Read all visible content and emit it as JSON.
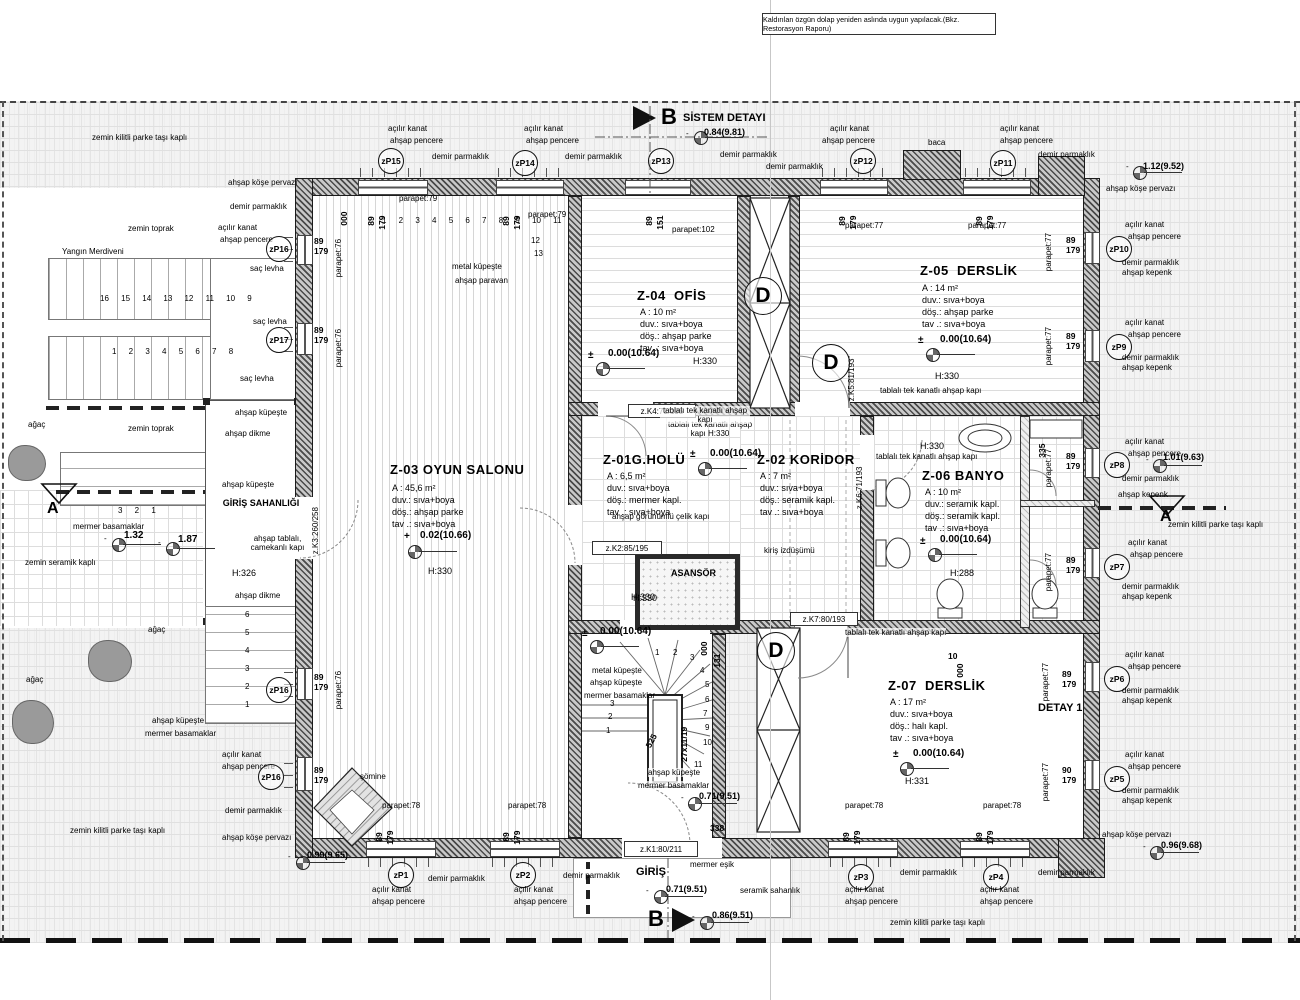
{
  "note": "Kaldırılan özgün dolap yeniden aslında uygun yapılacak.(Bkz. Restorasyon Raporu)",
  "markers": {
    "b": "B",
    "a": "A",
    "sistem_detayi": "SİSTEM DETAYI",
    "detay1": "DETAY 1"
  },
  "terms": {
    "acilir_kanat": "açılır kanat",
    "ahsap_pencere": "ahşap pencere",
    "demir_parmaklik": "demir parmaklık",
    "ahsap_kepenk": "ahşap kepenk",
    "ahsap_kose_pervazi": "ahşap köşe pervazı",
    "zemin_kilitli": "zemin kilitli parke taşı kaplı",
    "zemin_toprak": "zemin toprak",
    "zemin_seramik": "zemin seramik kaplı",
    "sac_levha": "saç levha",
    "agac": "ağaç",
    "ahsap_kupeste": "ahşap küpeşte",
    "ahsap_dikme": "ahşap dikme",
    "mermer_basamaklar": "mermer basamaklar",
    "metal_kupeste": "metal küpeşte",
    "ahsap_paravan": "ahşap paravan",
    "tablali_kapi": "tablalı tek kanatlı ahşap kapı",
    "celik_kapi": "ahşap görünümlü çelik kapı",
    "camekanli_kapi": "ahşap tablalı, camekanlı kapı",
    "somine": "şömine",
    "baca": "baca",
    "yangin_merdiveni": "Yangın Merdiveni",
    "kiris_izdusumu": "kiriş izdüşümü",
    "mermer_esik": "mermer eşik",
    "seramik_sahanlik": "seramik sahanlık",
    "giris": "GİRİŞ",
    "giris_sahanligi": "GİRİŞ SAHANLIĞI",
    "asansor": "ASANSÖR"
  },
  "rooms": {
    "z03": {
      "id": "Z-03",
      "name": "OYUN SALONU",
      "area": "A   : 45,6  m²",
      "duv": "duv.: sıva+boya",
      "dos": "döş.: ahşap parke",
      "tav": "tav .: sıva+boya",
      "sign": "+",
      "level": "0.02(10.66)",
      "height": "H:330"
    },
    "z04": {
      "id": "Z-04",
      "name": "OFİS",
      "area": "A   : 10  m²",
      "duv": "duv.: sıva+boya",
      "dos": "döş.: ahşap parke",
      "tav": "tav .: sıva+boya",
      "sign": "±",
      "level": "0.00(10.64)",
      "height": "H:330"
    },
    "z05": {
      "id": "Z-05",
      "name": "DERSLİK",
      "area": "A   : 14  m²",
      "duv": "duv.: sıva+boya",
      "dos": "döş.: ahşap parke",
      "tav": "tav .: sıva+boya",
      "sign": "±",
      "level": "0.00(10.64)",
      "height": "H:330"
    },
    "z01": {
      "id": "Z-01",
      "name": "G.HOLÜ",
      "area": "A   : 6,5  m²",
      "duv": "duv.: sıva+boya",
      "dos": "döş.: mermer kapl.",
      "tav": "tav .: sıva+boya",
      "sign": "±",
      "level": "0.00(10.64)",
      "height": "H:330"
    },
    "z02": {
      "id": "Z-02",
      "name": "KORİDOR",
      "area": "A   : 7  m²",
      "duv": "duv.: sıva+boya",
      "dos": "döş.: seramik kapl.",
      "tav": "tav .: sıva+boya"
    },
    "z06": {
      "id": "Z-06",
      "name": "BANYO",
      "area": "A   : 10  m²",
      "duv": "duv.: seramik kapl.",
      "dos": "döş.: seramik kapl.",
      "tav": "tav .: sıva+boya",
      "sign": "±",
      "level": "0.00(10.64)",
      "height": "H:288"
    },
    "z07": {
      "id": "Z-07",
      "name": "DERSLİK",
      "area": "A   : 17  m²",
      "duv": "duv.: sıva+boya",
      "dos": "döş.: halı kapl.",
      "tav": "tav .: sıva+boya",
      "sign": "±",
      "level": "0.00(10.64)",
      "height": "H:331"
    }
  },
  "doors": {
    "k1": "z.K1:80/211",
    "k2": "z.K2:85/195",
    "k3": "z.K3:260/258",
    "k4": "z.K4:71/195",
    "k5": "z.K5:81/193",
    "k6": "z.K6:71/193",
    "k7": "z.K7:80/193"
  },
  "window_tags": {
    "p1": "zP1",
    "p2": "zP2",
    "p3": "zP3",
    "p4": "zP4",
    "p5": "zP5",
    "p6": "zP6",
    "p7": "zP7",
    "p8": "zP8",
    "p9": "zP9",
    "p10": "zP10",
    "p11": "zP11",
    "p12": "zP12",
    "p13": "zP13",
    "p14": "zP14",
    "p15": "zP15",
    "p16": "zP16",
    "p17": "zP17"
  },
  "levels": {
    "l084": "0.84(9.81)",
    "l112": "1.12(9.52)",
    "l101": "1.01(9.63)",
    "l071": "0.71(9.51)",
    "l086": "0.86(9.51)",
    "l099": "0.99(9.65)",
    "l096": "0.96(9.68)",
    "l132": "1.32",
    "l187": "1.87",
    "minus": "-"
  },
  "dims": {
    "d89": "89",
    "d179": "179",
    "d90": "90",
    "d000": "000",
    "d131": "131",
    "d151": "151",
    "d338": "338",
    "d335": "335",
    "d525": "525",
    "d10": "10",
    "step": "27x11/19",
    "parapet76": "parapet:76",
    "parapet77": "parapet:77",
    "parapet78": "parapet:78",
    "parapet79": "parapet:79",
    "parapet102": "parapet:102",
    "h330": "H:330",
    "h326": "H:326",
    "h288": "H:288"
  },
  "stairs": {
    "fire_top": "16 15 14 13 12 11 10 9",
    "fire_bottom": "1 2 3 4 5 6 7 8",
    "z03_top": "1 2 3 4 5 6 7 8 9 10 11",
    "z03_extra1": "12",
    "z03_extra2": "13",
    "porch": "3 2 1",
    "left_ext": [
      "6",
      "5",
      "4",
      "3",
      "2",
      "1"
    ],
    "center": [
      "1",
      "2",
      "3",
      "4",
      "5",
      "6",
      "7",
      "9",
      "10",
      "11"
    ],
    "side": [
      "3",
      "2",
      "1"
    ]
  }
}
